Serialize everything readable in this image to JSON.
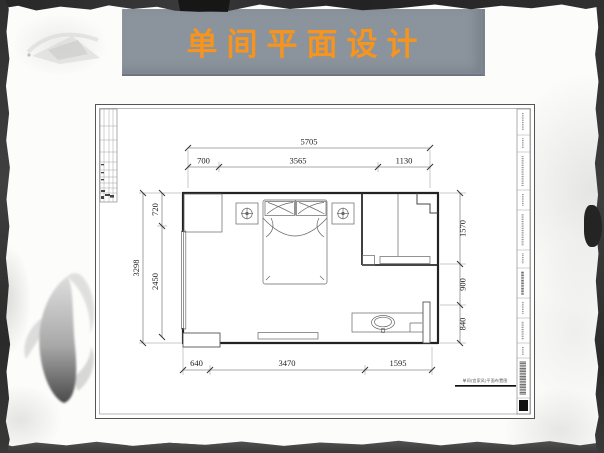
{
  "slide": {
    "title": "单间平面设计"
  },
  "colors": {
    "title_orange": "#f7941d",
    "banner_gray": "#8b939c",
    "drawing_line": "#333333"
  },
  "drawing": {
    "caption": "单间(宜家风)平面布置图",
    "dimensions": {
      "top_total": "5705",
      "top_chain": [
        "700",
        "3565",
        "1130"
      ],
      "left_total": "3298",
      "left_chain": [
        "720",
        "2450"
      ],
      "right_chain": [
        "1570",
        "900",
        "840"
      ],
      "bottom_chain": [
        "640",
        "3470",
        "1595"
      ]
    }
  }
}
